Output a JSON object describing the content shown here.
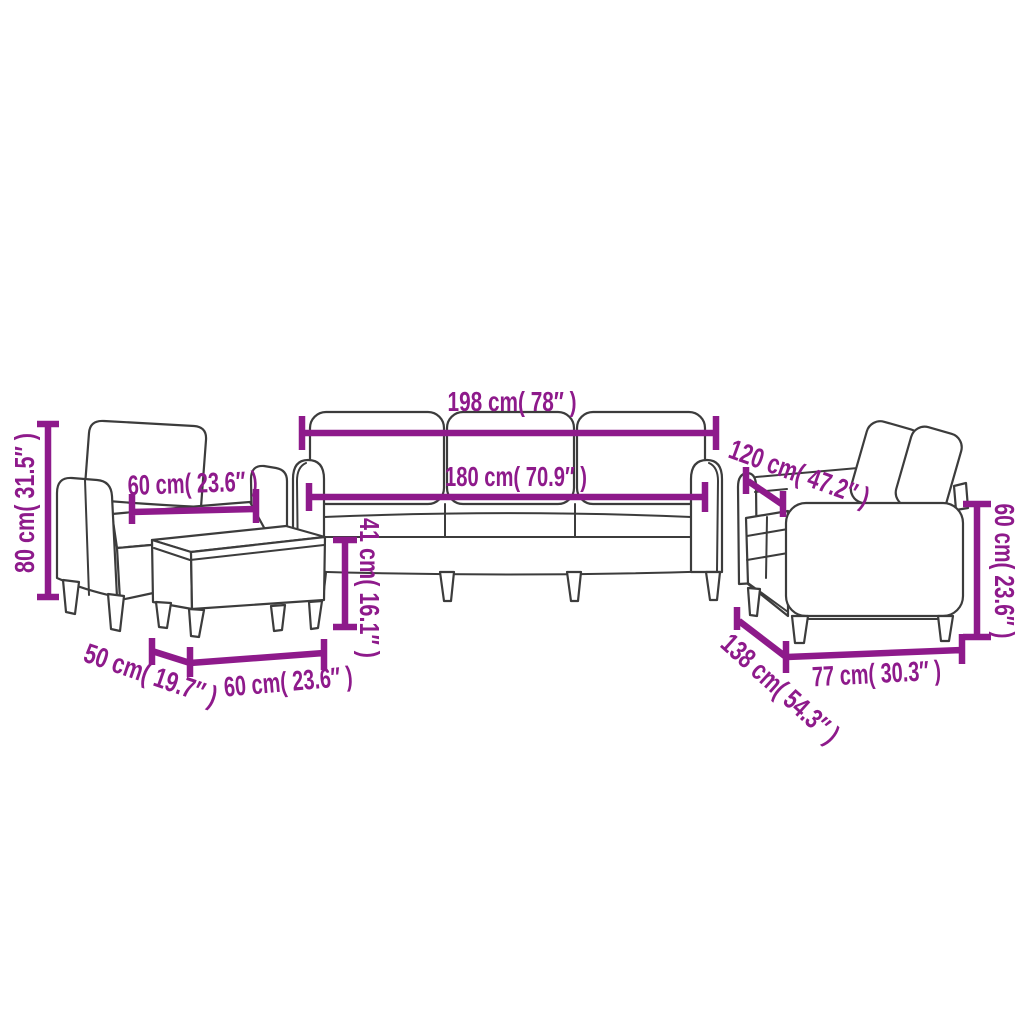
{
  "diagram": {
    "accent_color": "#8E1A8B",
    "outline_color": "#3C3C3C",
    "background_color": "#FFFFFF",
    "labels": {
      "armchair_height": "80 cm( 31.5″ )",
      "armchair_seat_width": "60 cm( 23.6″ )",
      "sofa3_overall_width": "198 cm( 78″ )",
      "sofa3_inner_width": "180 cm( 70.9″ )",
      "seat_height": "41 cm( 16.1″ )",
      "footstool_depth": "50 cm( 19.7″ )",
      "footstool_width": "60 cm( 23.6″ )",
      "sofa2_depth": "120 cm( 47.2″ )",
      "sofa2_back_height": "60 cm( 23.6″ )",
      "sofa2_diagonal_depth": "138 cm( 54.3″ )",
      "sofa2_seat_width": "77 cm( 30.3″ )"
    }
  }
}
